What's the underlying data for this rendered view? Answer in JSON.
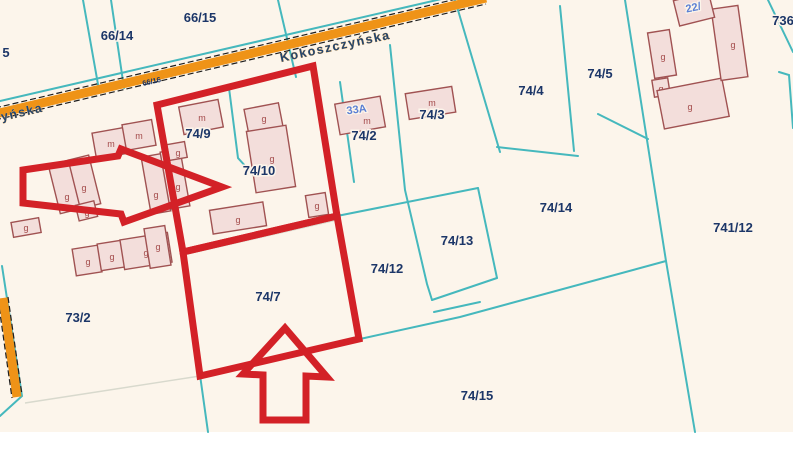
{
  "map": {
    "street": {
      "name": "Kokoszczyńska",
      "name_fragment": "yńska",
      "road_parcel_label": "66/16"
    },
    "parcels": [
      {
        "label": "5"
      },
      {
        "label": "66/14"
      },
      {
        "label": "66/15"
      },
      {
        "label": "736"
      },
      {
        "label": "74/2"
      },
      {
        "label": "74/3"
      },
      {
        "label": "74/4"
      },
      {
        "label": "74/5"
      },
      {
        "label": "74/9"
      },
      {
        "label": "74/10"
      },
      {
        "label": "74/12"
      },
      {
        "label": "74/13"
      },
      {
        "label": "74/14"
      },
      {
        "label": "741/12"
      },
      {
        "label": "74/7"
      },
      {
        "label": "73/2"
      },
      {
        "label": "74/15"
      }
    ],
    "addresses": [
      {
        "label": "33A"
      },
      {
        "label": "22/"
      }
    ],
    "buildings": [
      {
        "label": "m"
      },
      {
        "label": "m"
      },
      {
        "label": "g"
      },
      {
        "label": "g"
      },
      {
        "label": "g"
      },
      {
        "label": "g"
      },
      {
        "label": "g"
      },
      {
        "label": "g"
      },
      {
        "label": "g"
      },
      {
        "label": "g"
      },
      {
        "label": "g"
      },
      {
        "label": "g"
      },
      {
        "label": "g"
      },
      {
        "label": "m"
      },
      {
        "label": "g"
      },
      {
        "label": "g"
      },
      {
        "label": "g"
      },
      {
        "label": "g"
      },
      {
        "label": "m"
      },
      {
        "label": "m"
      },
      {
        "label": "g"
      },
      {
        "label": "g"
      },
      {
        "label": "g"
      },
      {
        "label": "g"
      },
      {
        "label": ""
      }
    ],
    "colors": {
      "background": "#fcf5eb",
      "parcel_line": "#45b8bd",
      "road_fill": "#ef9317",
      "building_fill": "#f3dedb",
      "building_stroke": "#a05252",
      "parcel_label": "#1c3668",
      "address_label": "#5b7fd4",
      "highlight_red": "#d32127"
    }
  }
}
